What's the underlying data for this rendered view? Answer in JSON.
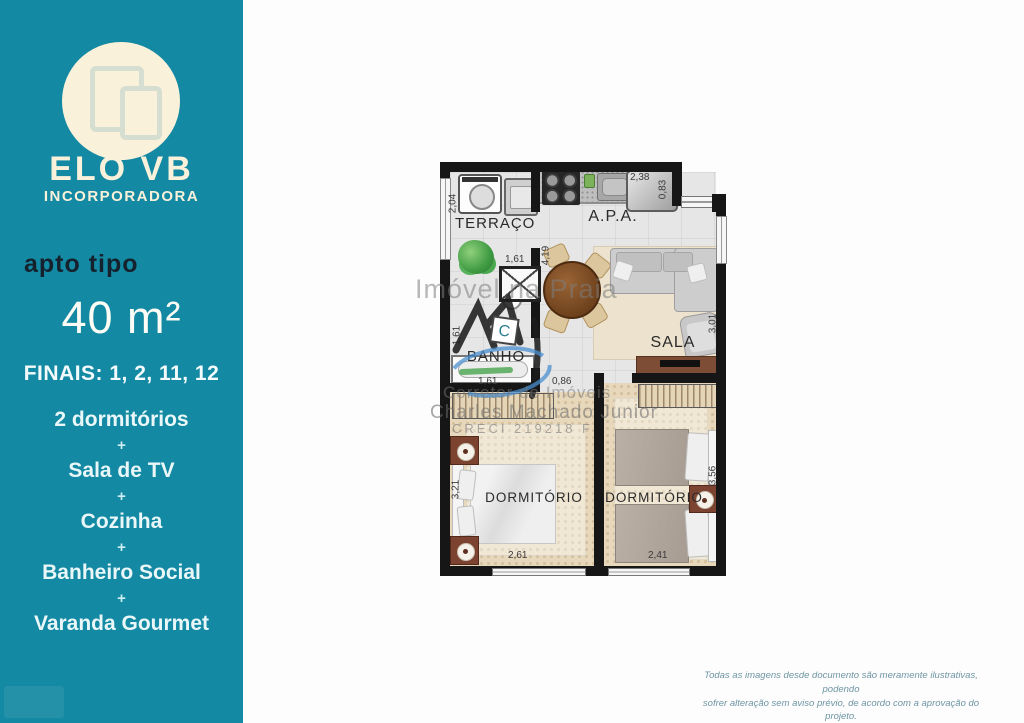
{
  "sidebar": {
    "logo": {
      "brand": "ELO VB",
      "subtitle": "INCORPORADORA"
    },
    "apt_type_label": "apto tipo",
    "area": "40 m²",
    "finals": "FINAIS: 1, 2, 11, 12",
    "separator": "+",
    "features": [
      "2 dormitórios",
      "Sala de TV",
      "Cozinha",
      "Banheiro Social",
      "Varanda Gourmet"
    ],
    "colors": {
      "background": "#1489a3",
      "cream": "#faf1da",
      "dark_text": "#15212d"
    }
  },
  "floorplan": {
    "rooms": {
      "terraco": {
        "label": "TERRAÇO",
        "dims": {
          "height": "2,04",
          "width": "1,61"
        }
      },
      "apa": {
        "label": "A.P.A.",
        "dims": {
          "height": "4,19",
          "fridge_width": "2,38",
          "fridge_depth": "0,83"
        }
      },
      "banho": {
        "label": "BANHO",
        "dims": {
          "height": "1,61",
          "width": "1,61"
        }
      },
      "sala": {
        "label": "SALA",
        "dims": {
          "height": "3,01"
        }
      },
      "corridor": {
        "dims": {
          "door": "0,86"
        }
      },
      "dorm1": {
        "label": "DORMITÓRIO",
        "dims": {
          "height": "3,21",
          "width": "2,61"
        }
      },
      "dorm2": {
        "label": "DORMITÓRIO",
        "dims": {
          "height": "3,56",
          "width": "2,41"
        }
      }
    }
  },
  "watermark": {
    "title": "Imóvel na Praia",
    "logo_letter": "C",
    "role": "Corretor de Imóveis",
    "name": "Charles Machado Junior",
    "creci": "CRECI   219218 F"
  },
  "disclaimer": {
    "line1": "Todas as imagens desde documento são meramente ilustrativas, podendo",
    "line2": "sofrer alteração sem aviso prévio, de acordo com a aprovação do projeto."
  }
}
